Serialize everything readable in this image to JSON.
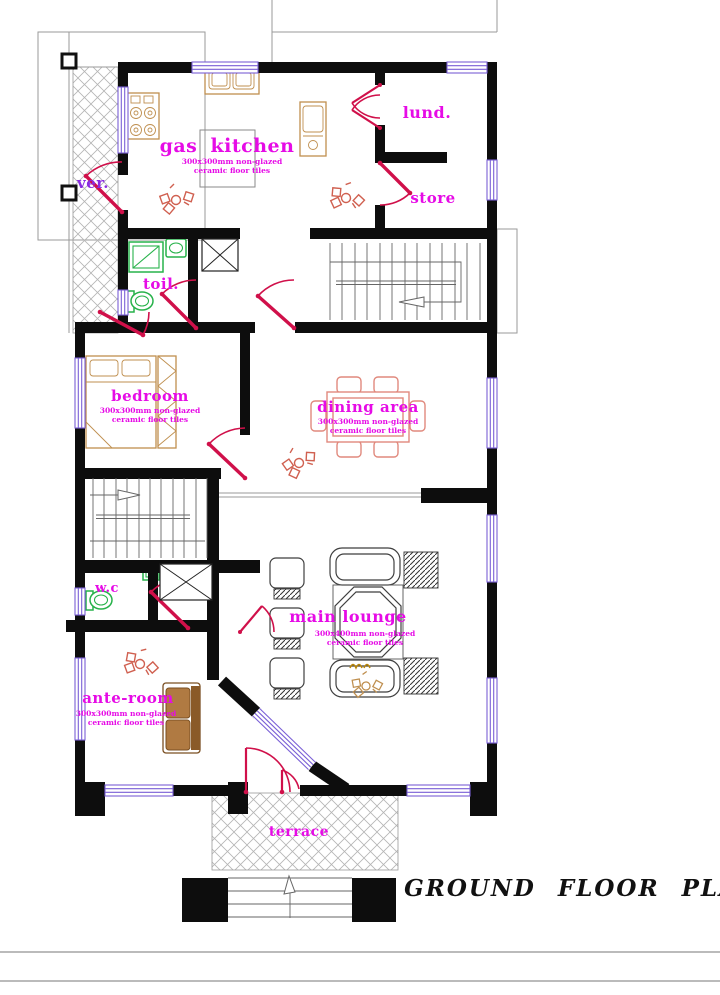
{
  "title": {
    "text": "GROUND FLOOR PLAN"
  },
  "colors": {
    "wall": "#0d0d0d",
    "window": "#7a5fd6",
    "door": "#d0104a",
    "label": "#e60be6",
    "label2": "#8a2be2",
    "fixture": "#27b24a",
    "wood": "#bf8f4f",
    "dining": "#e0897d",
    "hatch": "#b4b4b4",
    "outline": "#9a9a9a",
    "stair": "#666666",
    "lounge": "#3f3f3f",
    "sofa_fill": "#b07a42",
    "sofa_dark": "#8a5a28",
    "sofa_edge": "#7a4f22",
    "sketch": "#d06050",
    "island": "#8a8a8a",
    "title_color": "#111111"
  },
  "rooms": {
    "kitchen": {
      "label": "gas kitchen",
      "tile_line1": "300x300mm non-glazed",
      "tile_line2": "ceramic floor tiles"
    },
    "laundry": {
      "label": "lund."
    },
    "store": {
      "label": "store"
    },
    "veranda": {
      "label": "ver."
    },
    "toilet": {
      "label": "toil."
    },
    "bedroom": {
      "label": "bedroom",
      "tile_line1": "300x300mm non-glazed",
      "tile_line2": "ceramic floor tiles"
    },
    "dining": {
      "label": "dining area",
      "tile_line1": "300x300mm non-glazed",
      "tile_line2": "ceramic floor tiles"
    },
    "wc": {
      "label": "w.c"
    },
    "ante_room": {
      "label": "ante-room",
      "tile_line1": "300x300mm non-glazed",
      "tile_line2": "ceramic floor tiles"
    },
    "main_lounge": {
      "label": "main lounge",
      "tile_line1": "300x400mm non-glazed",
      "tile_line2": "ceramic floor tiles"
    },
    "terrace": {
      "label": "terrace"
    }
  }
}
